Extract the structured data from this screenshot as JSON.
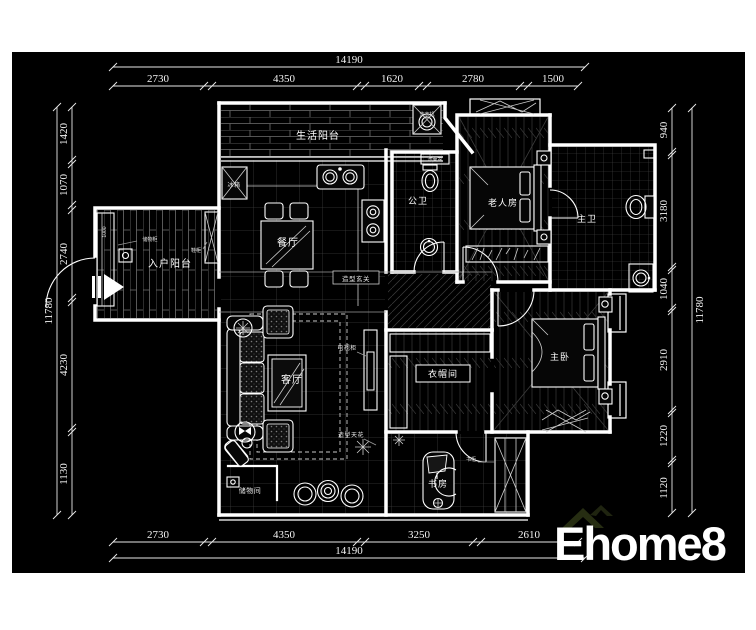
{
  "plan": {
    "rooms": {
      "living_balcony": "生活阳台",
      "dining": "餐厅",
      "public_bath": "公卫",
      "elder_room": "老人房",
      "master_bath": "主卫",
      "entry_balcony": "入户阳台",
      "living_room": "客厅",
      "cloakroom": "衣帽间",
      "master_bedroom": "主卧",
      "study": "书房",
      "storage_room": "储物间"
    },
    "annotations": {
      "washing_machine": "洗衣机",
      "fridge": "冰箱",
      "basin": "洗面盆",
      "storage_cabinet": "储物柜",
      "shoe_cabinet": "鞋柜",
      "entry_feature": "造型玄关",
      "tv_cabinet": "电视柜",
      "ceiling_feature": "造型天花",
      "bookcase": "书柜",
      "cabinet_width": "1000"
    },
    "dimensions": {
      "top": {
        "total": "14190",
        "segments": [
          "2730",
          "4350",
          "1620",
          "2780",
          "1500"
        ]
      },
      "bottom": {
        "total": "14190",
        "segments": [
          "2730",
          "4350",
          "3250",
          "2610"
        ]
      },
      "left": {
        "total": "11780",
        "segments": [
          "1420",
          "1070",
          "2740",
          "4230",
          "1130"
        ]
      },
      "right": {
        "total": "11780",
        "segments": [
          "940",
          "3180",
          "1040",
          "2910",
          "1220",
          "1120"
        ]
      }
    }
  },
  "watermark": {
    "brand": "Ehome8",
    "tagline": "家装．缔造完美生活"
  },
  "colors": {
    "page_background": "#ffffff",
    "canvas_background": "#000000",
    "line": "#ffffff",
    "tile_grid": "#3c3c3c",
    "brand": "#30200e",
    "tagline": "#e8e0b4"
  }
}
